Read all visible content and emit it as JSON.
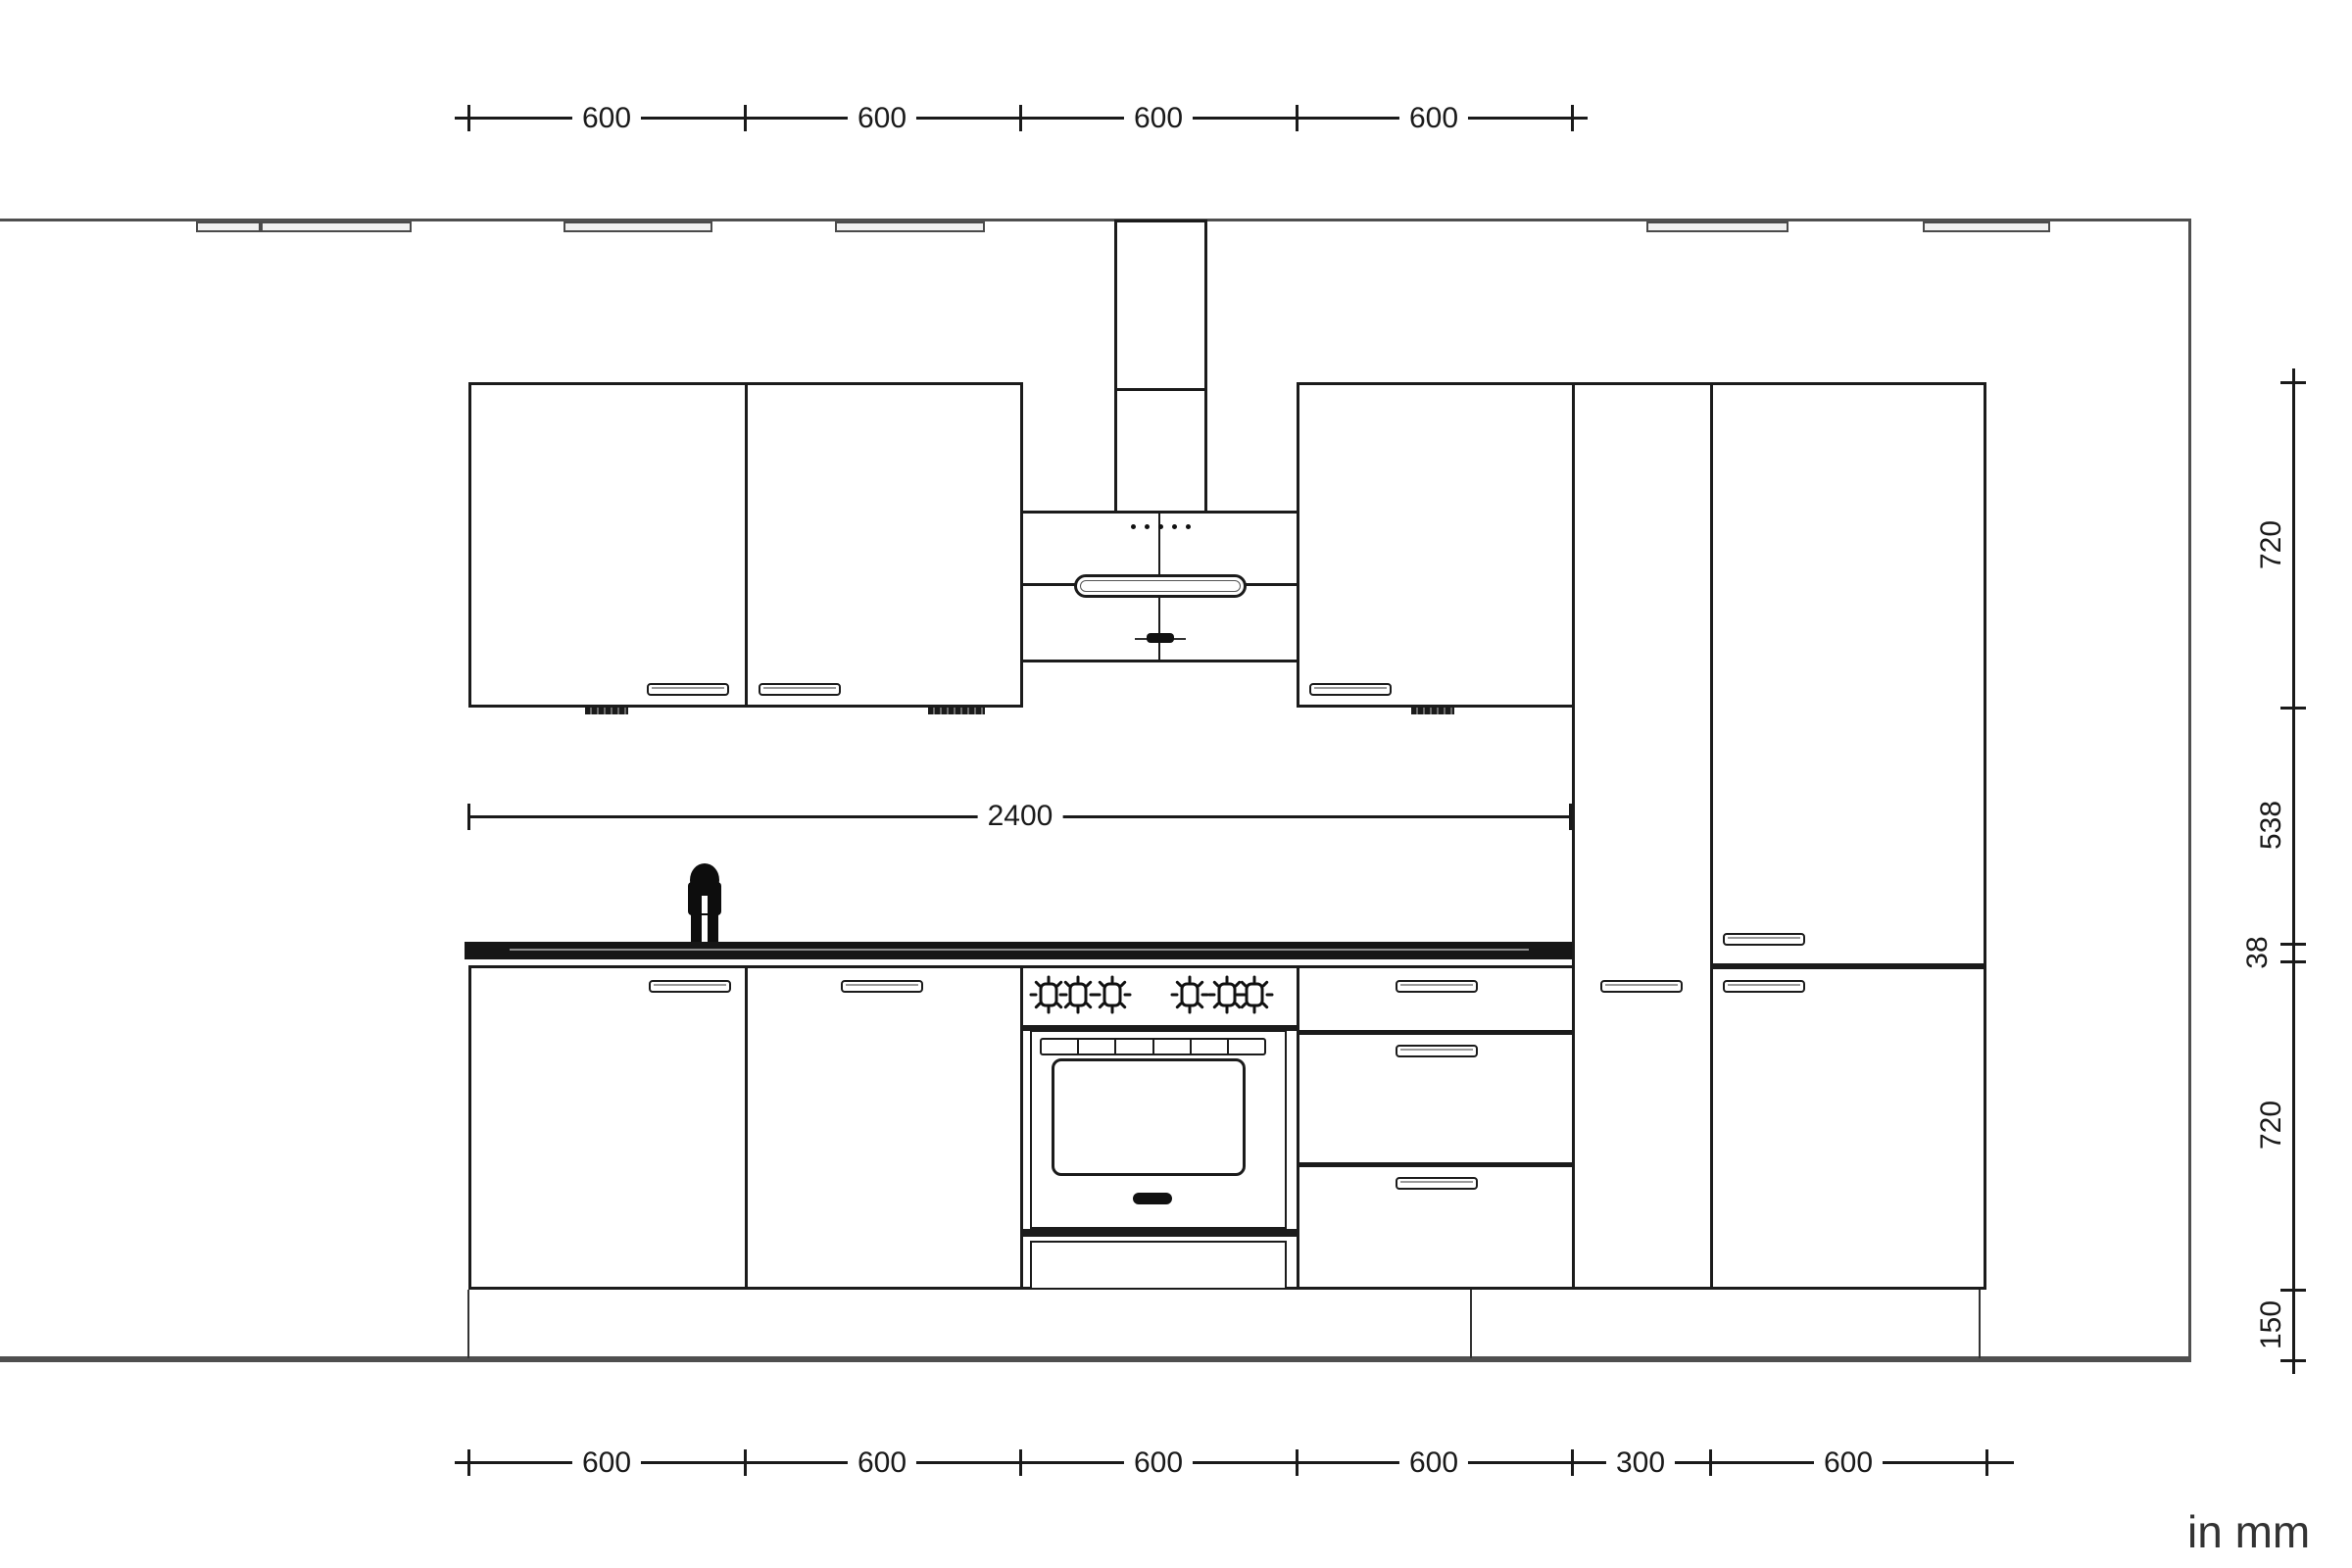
{
  "units_label": "in mm",
  "colors": {
    "line": "#1b1b1b",
    "room": "#4f4f4f",
    "dim": "#1a1a1a",
    "countertop": "#161616",
    "trim_fill": "#f0f0f0"
  },
  "dims": {
    "top": {
      "labels": [
        "600",
        "600",
        "600",
        "600"
      ]
    },
    "bottom": {
      "labels": [
        "600",
        "600",
        "600",
        "600",
        "300",
        "600"
      ]
    },
    "right": {
      "labels": [
        "720",
        "538",
        "38",
        "720",
        "150"
      ]
    },
    "overall_width": "2400"
  }
}
